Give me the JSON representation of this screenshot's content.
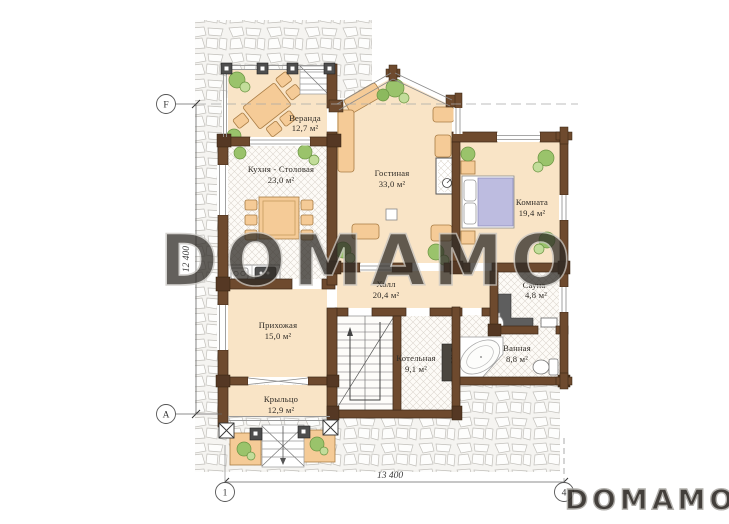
{
  "watermark": {
    "center": "DOMAMO",
    "corner": "DOMAMO"
  },
  "dimensions": {
    "vertical": "12 400",
    "horizontal": "13 400"
  },
  "axes": {
    "f": "F",
    "a": "A",
    "one": "1",
    "four": "4"
  },
  "annotations": {
    "chimney_diameter": "Ø400"
  },
  "rooms": [
    {
      "id": "veranda",
      "name": "Веранда",
      "area": "12,7 м²"
    },
    {
      "id": "kitchen",
      "name": "Кухня - Столовая",
      "area": "23,0 м²"
    },
    {
      "id": "living",
      "name": "Гостиная",
      "area": "33,0 м²"
    },
    {
      "id": "bedroom",
      "name": "Комната",
      "area": "19,4 м²"
    },
    {
      "id": "hall",
      "name": "Холл",
      "area": "20,4 м²"
    },
    {
      "id": "sauna",
      "name": "Сауна",
      "area": "4,8 м²"
    },
    {
      "id": "entry",
      "name": "Прихожая",
      "area": "15,0 м²"
    },
    {
      "id": "boiler",
      "name": "Котельная",
      "area": "9,1 м²"
    },
    {
      "id": "bath",
      "name": "Ванная",
      "area": "8,8 м²"
    },
    {
      "id": "porch",
      "name": "Крыльцо",
      "area": "12,9 м²"
    }
  ],
  "colors": {
    "floor_beige": "#f9e4c6",
    "wall_brown": "#6e4a2e",
    "wall_dark": "#553824",
    "furniture_tan": "#f5cb97",
    "bed_purple": "#bdbce0",
    "plant_green": "#9ac36b",
    "stone_gray": "#c2c0bb",
    "watermark_gray": "#c7c5c1"
  }
}
